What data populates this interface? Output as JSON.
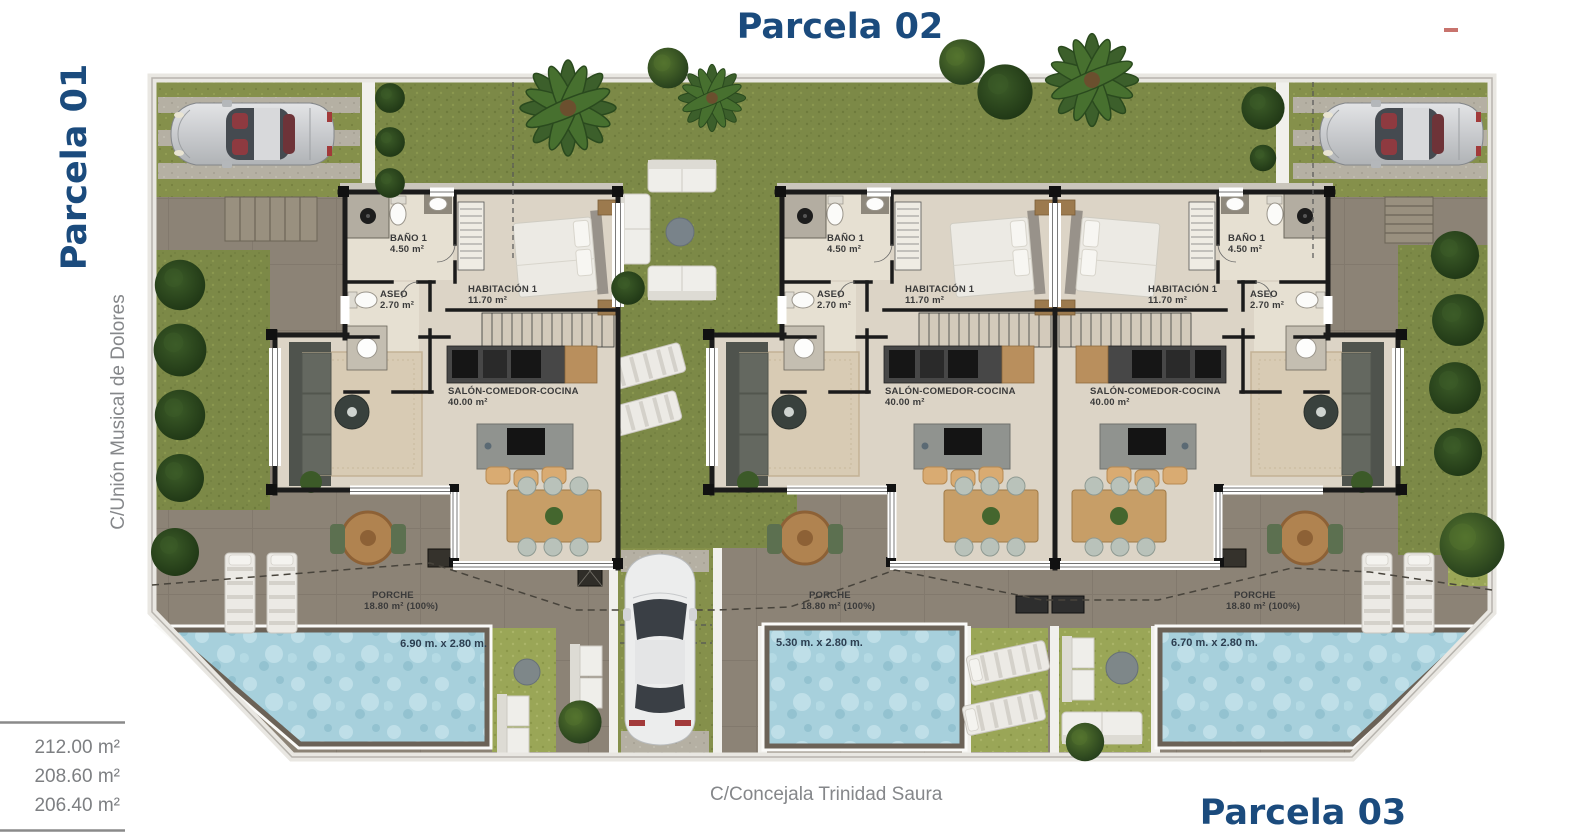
{
  "titles": {
    "parcela_01": "Parcela 01",
    "parcela_02": "Parcela 02",
    "parcela_03": "Parcela 03"
  },
  "streets": {
    "left": "C/Unión Musical de Dolores",
    "bottom": "C/Concejala Trinidad Saura"
  },
  "areas_table": {
    "row1": "212.00 m²",
    "row2": "208.60 m²",
    "row3": "206.40 m²"
  },
  "units": {
    "left": {
      "bano_name": "BAÑO 1",
      "bano_area": "4.50 m²",
      "aseo_name": "ASEO",
      "aseo_area": "2.70 m²",
      "hab_name": "HABITACIÓN 1",
      "hab_area": "11.70 m²",
      "salon_name": "SALÓN-COMEDOR-COCINA",
      "salon_area": "40.00 m²",
      "porche_name": "PORCHE",
      "porche_area": "18.80 m² (100%)",
      "pool_size": "6.90 m. x 2.80 m."
    },
    "middle": {
      "bano_name": "BAÑO 1",
      "bano_area": "4.50 m²",
      "aseo_name": "ASEO",
      "aseo_area": "2.70 m²",
      "hab_name": "HABITACIÓN 1",
      "hab_area": "11.70 m²",
      "salon_name": "SALÓN-COMEDOR-COCINA",
      "salon_area": "40.00 m²",
      "porche_name": "PORCHE",
      "porche_area": "18.80 m² (100%)",
      "pool_size": "5.30 m. x 2.80 m."
    },
    "right": {
      "bano_name": "BAÑO 1",
      "bano_area": "4.50 m²",
      "aseo_name": "ASEO",
      "aseo_area": "2.70 m²",
      "hab_name": "HABITACIÓN 1",
      "hab_area": "11.70 m²",
      "salon_name": "SALÓN-COMEDOR-COCINA",
      "salon_area": "40.00 m²",
      "porche_name": "PORCHE",
      "porche_area": "18.80 m² (100%)",
      "pool_size": "6.70 m. x 2.80 m."
    }
  },
  "colors": {
    "accent_blue": "#1b4b7d",
    "muted_text": "#85878a",
    "terrace": "#8c8376",
    "grass_dark": "#7c8947",
    "grass_light": "#9aa657",
    "pool_water": "#a7d0dc",
    "wall": "#1b1b1b",
    "floor": "#dcd4c6"
  }
}
